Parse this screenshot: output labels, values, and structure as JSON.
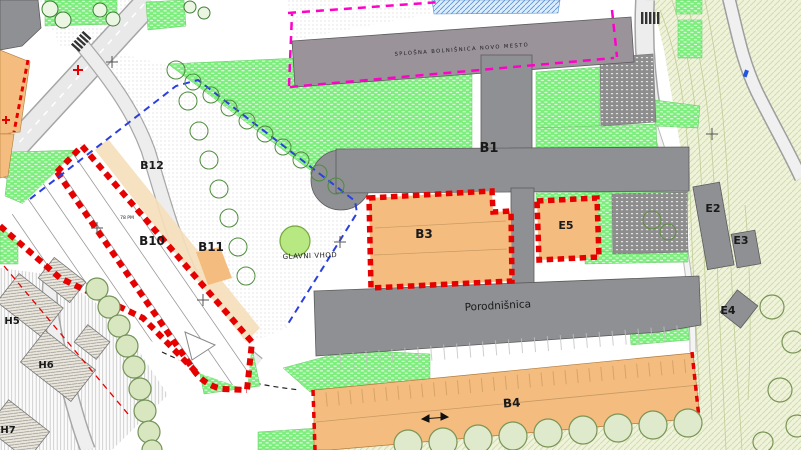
{
  "plan": {
    "building_labels": {
      "b1": "B1",
      "b3": "B3",
      "b4": "B4",
      "b10": "B10",
      "b11": "B11",
      "b12": "B12",
      "e2": "E2",
      "e3": "E3",
      "e4": "E4",
      "e5": "E5",
      "h5": "H5",
      "h6": "H6",
      "h7": "H7"
    },
    "annotations": {
      "main_entrance": "GLAVNI VHOD",
      "maternity_hospital": "Porodnišnica",
      "site_band": "SPLOŠNA BOLNIŠNICA NOVO MESTO",
      "parking_capacity": "78 PM"
    },
    "colors": {
      "lawn_green": "#7dee7d",
      "zone_orange": "#f4bd7f",
      "building_gray": "#8e9093",
      "band_gray": "#9a939a",
      "boundary_red": "#e60000",
      "guide_blue": "#2a3fe0",
      "guide_magenta": "#ff00c8",
      "terrain_tint": "#eef3da",
      "dark_parking": "#8d8d8d"
    }
  }
}
